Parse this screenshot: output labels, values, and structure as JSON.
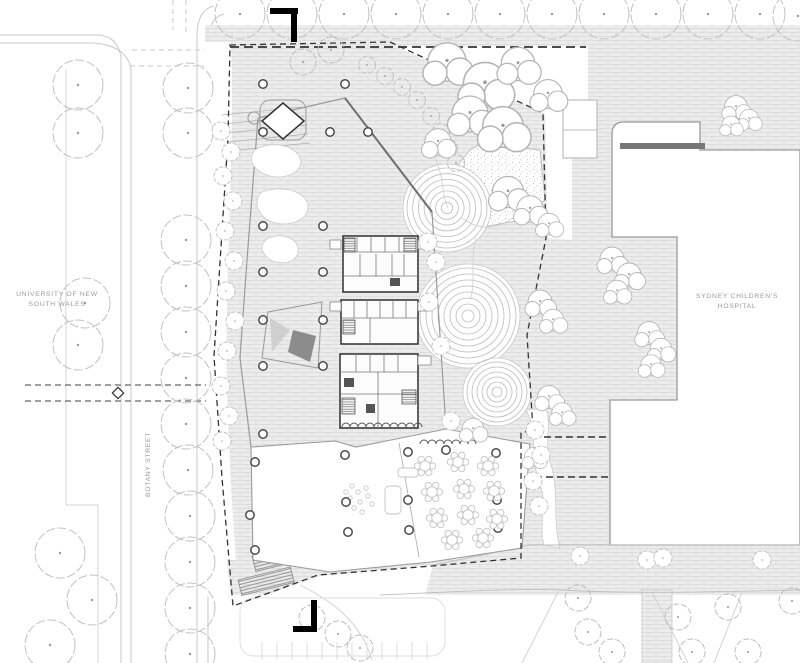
{
  "drawing": {
    "type": "architectural-site-plan",
    "labels": {
      "university_line1": "UNIVERSITY OF NEW",
      "university_line2": "SOUTH WALES",
      "hospital_line1": "SYDNEY CHILDREN'S",
      "hospital_line2": "HOSPITAL",
      "street_vertical": "BOTANY STREET"
    },
    "colors": {
      "background": "#ffffff",
      "paving_fill": "#ececec",
      "paving_joint": "#d6d6d6",
      "line_light": "#c4c4c4",
      "line_medium": "#9a9a9a",
      "line_dark": "#4a4a4a",
      "ink": "#000000",
      "label_gray": "#9b9b9b"
    },
    "plan": {
      "trees_large": [
        [
          240,
          14
        ],
        [
          292,
          14
        ],
        [
          344,
          14
        ],
        [
          396,
          14
        ],
        [
          448,
          14
        ],
        [
          500,
          14
        ],
        [
          552,
          14
        ],
        [
          604,
          14
        ],
        [
          656,
          14
        ],
        [
          708,
          14
        ],
        [
          760,
          14
        ],
        [
          798,
          16
        ],
        [
          78,
          85
        ],
        [
          78,
          133
        ],
        [
          85,
          303
        ],
        [
          78,
          345
        ],
        [
          60,
          553
        ],
        [
          92,
          600
        ],
        [
          50,
          645
        ],
        [
          188,
          88
        ],
        [
          188,
          133
        ],
        [
          186,
          240
        ],
        [
          186,
          286
        ],
        [
          186,
          332
        ],
        [
          186,
          378
        ],
        [
          186,
          424
        ],
        [
          188,
          470
        ],
        [
          190,
          516
        ],
        [
          190,
          562
        ],
        [
          190,
          608
        ],
        [
          190,
          654
        ]
      ],
      "trees_medium": [
        [
          303,
          62
        ],
        [
          331,
          50
        ],
        [
          312,
          618
        ],
        [
          338,
          634
        ],
        [
          360,
          648
        ],
        [
          578,
          598
        ],
        [
          588,
          632
        ],
        [
          612,
          652
        ],
        [
          678,
          617
        ],
        [
          692,
          652
        ],
        [
          728,
          607
        ],
        [
          748,
          652
        ],
        [
          792,
          601
        ]
      ],
      "trees_small": [
        [
          367,
          65
        ],
        [
          385,
          76
        ],
        [
          402,
          87
        ],
        [
          417,
          100
        ],
        [
          431,
          116
        ],
        [
          441,
          132
        ],
        [
          449,
          148
        ],
        [
          456,
          163
        ]
      ],
      "tree_clusters": [
        [
          447,
          62,
          1.6
        ],
        [
          485,
          84,
          1.8
        ],
        [
          518,
          64,
          1.4
        ],
        [
          548,
          94,
          1.2
        ],
        [
          470,
          114,
          1.5
        ],
        [
          503,
          127,
          1.7
        ],
        [
          438,
          142,
          1.1
        ],
        [
          508,
          192,
          1.3
        ],
        [
          530,
          209,
          1.1
        ],
        [
          549,
          224,
          0.9
        ],
        [
          540,
          302,
          1.0
        ],
        [
          553,
          320,
          0.9
        ],
        [
          549,
          397,
          0.95
        ],
        [
          562,
          413,
          0.85
        ],
        [
          534,
          457,
          0.8
        ],
        [
          612,
          259,
          1.0
        ],
        [
          629,
          275,
          1.0
        ],
        [
          617,
          291,
          0.9
        ],
        [
          649,
          333,
          0.95
        ],
        [
          661,
          349,
          0.9
        ],
        [
          651,
          365,
          0.85
        ],
        [
          736,
          107,
          0.95
        ],
        [
          749,
          119,
          0.8
        ],
        [
          731,
          125,
          0.75
        ],
        [
          473,
          429,
          0.9
        ]
      ],
      "shrubs": [
        [
          221,
          131
        ],
        [
          231,
          152
        ],
        [
          223,
          176
        ],
        [
          233,
          201
        ],
        [
          225,
          231
        ],
        [
          234,
          261
        ],
        [
          226,
          291
        ],
        [
          235,
          321
        ],
        [
          227,
          351
        ],
        [
          221,
          386
        ],
        [
          229,
          416
        ],
        [
          222,
          441
        ],
        [
          428,
          242
        ],
        [
          436,
          262
        ],
        [
          429,
          302
        ],
        [
          441,
          346
        ],
        [
          451,
          421
        ],
        [
          580,
          556
        ],
        [
          647,
          560
        ],
        [
          663,
          558
        ],
        [
          762,
          560
        ],
        [
          535,
          430
        ],
        [
          541,
          455
        ],
        [
          533,
          481
        ],
        [
          539,
          506
        ]
      ],
      "columns": [
        [
          263,
          84
        ],
        [
          345,
          84
        ],
        [
          263,
          132
        ],
        [
          330,
          132
        ],
        [
          368,
          132
        ],
        [
          263,
          226
        ],
        [
          323,
          226
        ],
        [
          263,
          272
        ],
        [
          323,
          272
        ],
        [
          263,
          320
        ],
        [
          323,
          320
        ],
        [
          263,
          366
        ],
        [
          323,
          366
        ],
        [
          263,
          434
        ],
        [
          345,
          455
        ],
        [
          408,
          452
        ],
        [
          446,
          450
        ],
        [
          496,
          453
        ],
        [
          346,
          502
        ],
        [
          408,
          500
        ],
        [
          497,
          500
        ],
        [
          348,
          532
        ],
        [
          409,
          530
        ],
        [
          498,
          528
        ],
        [
          255,
          462
        ],
        [
          250,
          515
        ],
        [
          255,
          550
        ]
      ],
      "tables": [
        [
          425,
          466
        ],
        [
          458,
          462
        ],
        [
          488,
          466
        ],
        [
          432,
          492
        ],
        [
          464,
          489
        ],
        [
          494,
          491
        ],
        [
          437,
          518
        ],
        [
          468,
          515
        ],
        [
          497,
          519
        ],
        [
          452,
          540
        ],
        [
          483,
          538
        ]
      ],
      "furniture_dots": [
        [
          352,
          486
        ],
        [
          358,
          492
        ],
        [
          350,
          498
        ],
        [
          360,
          502
        ],
        [
          354,
          508
        ],
        [
          366,
          488
        ],
        [
          368,
          496
        ],
        [
          372,
          504
        ],
        [
          346,
          492
        ],
        [
          362,
          512
        ]
      ],
      "mounds": [
        {
          "cx": 447,
          "cy": 208,
          "rmax": 40,
          "rings": 7
        },
        {
          "cx": 468,
          "cy": 316,
          "rmax": 48,
          "rings": 8
        },
        {
          "cx": 497,
          "cy": 392,
          "rmax": 30,
          "rings": 6
        }
      ]
    }
  }
}
